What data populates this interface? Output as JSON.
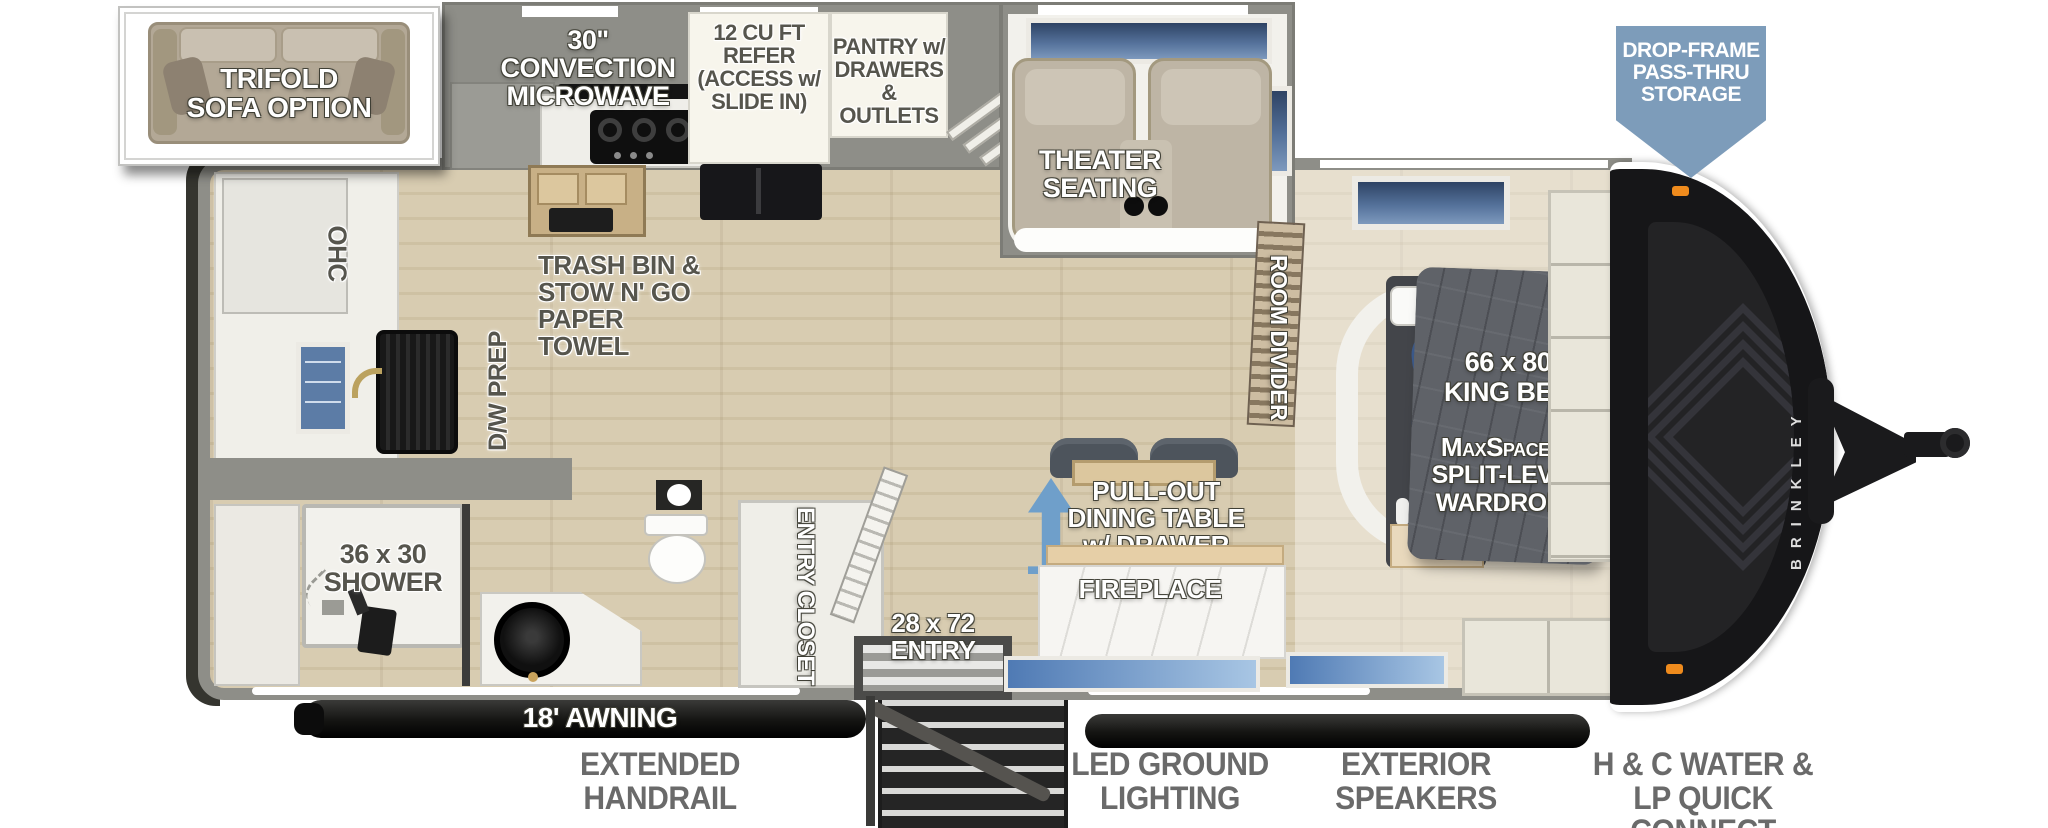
{
  "inset": {
    "label": "TRIFOLD\nSOFA OPTION"
  },
  "callout": {
    "drop_frame": "DROP-FRAME\nPASS-THRU\nSTORAGE"
  },
  "kitchen": {
    "microwave": "30\" CONVECTION\nMICROWAVE",
    "refer": "12 CU FT\nREFER\n(ACCESS w/\nSLIDE IN)",
    "pantry": "PANTRY w/\nDRAWERS\n& OUTLETS",
    "trash": "TRASH BIN &\nSTOW N' GO\nPAPER TOWEL",
    "ohc": "OHC",
    "dw_prep": "D/W PREP"
  },
  "living": {
    "theater": "THEATER SEATING",
    "room_divider": "ROOM DIVIDER",
    "dining": "PULL-OUT\nDINING TABLE\nw/ DRAWER",
    "fireplace": "FIREPLACE"
  },
  "bedroom": {
    "bed_size": "66 x 80",
    "bed": "KING BED",
    "wardrobe_line1": "MaxSpace™",
    "wardrobe_line2": "SPLIT-LEVEL",
    "wardrobe_line3": "WARDROBE"
  },
  "bath": {
    "shower": "36 x 30\nSHOWER",
    "entry_closet": "ENTRY CLOSET"
  },
  "entry": {
    "door": "28 x 72\nENTRY",
    "awning": "18' AWNING"
  },
  "exterior": {
    "brand": "BRINKLEY",
    "features": [
      "EXTENDED\nHANDRAIL",
      "LED GROUND\nLIGHTING",
      "EXTERIOR\nSPEAKERS",
      "H & C WATER &\nLP QUICK CONNECT"
    ]
  },
  "colors": {
    "callout_blue": "#7d9cba",
    "arrow_blue": "#6f9fca",
    "wall_gray": "#8e8e88",
    "wood": "#d8ccb1",
    "cap_black": "#161618",
    "marker_orange": "#ef8b1d"
  }
}
